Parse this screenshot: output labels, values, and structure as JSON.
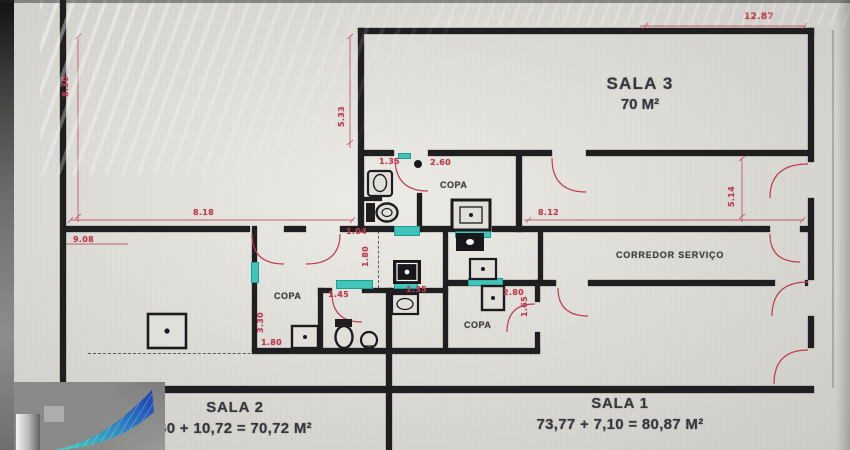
{
  "rooms": {
    "sala3": {
      "label": "SALA 3",
      "area": "70 M²"
    },
    "sala2": {
      "label": "SALA 2",
      "area": "60 + 10,72 = 70,72 M²"
    },
    "sala1": {
      "label": "SALA 1",
      "area": "73,77 + 7,10 = 80,87 M²"
    },
    "copa_label": "COPA",
    "corridor_label": "CORREDOR SERVIÇO"
  },
  "dims": [
    {
      "v": "8.30"
    },
    {
      "v": "5.33"
    },
    {
      "v": "12.87"
    },
    {
      "v": "8.18"
    },
    {
      "v": "8.12"
    },
    {
      "v": "5.14"
    },
    {
      "v": "9.08"
    },
    {
      "v": "1.04"
    },
    {
      "v": "1.35"
    },
    {
      "v": "2.60"
    },
    {
      "v": "1.80"
    },
    {
      "v": "1.45"
    },
    {
      "v": "1.35"
    },
    {
      "v": "2.80"
    },
    {
      "v": "1.65"
    },
    {
      "v": "3.30"
    },
    {
      "v": "1.80"
    }
  ],
  "colors": {
    "dimension_red": "#bf3a4c",
    "highlight_teal": "#3fc7bd",
    "wall_black": "#1b1b1e",
    "logo_blue": "#1b3db0",
    "logo_teal": "#49d3be"
  }
}
